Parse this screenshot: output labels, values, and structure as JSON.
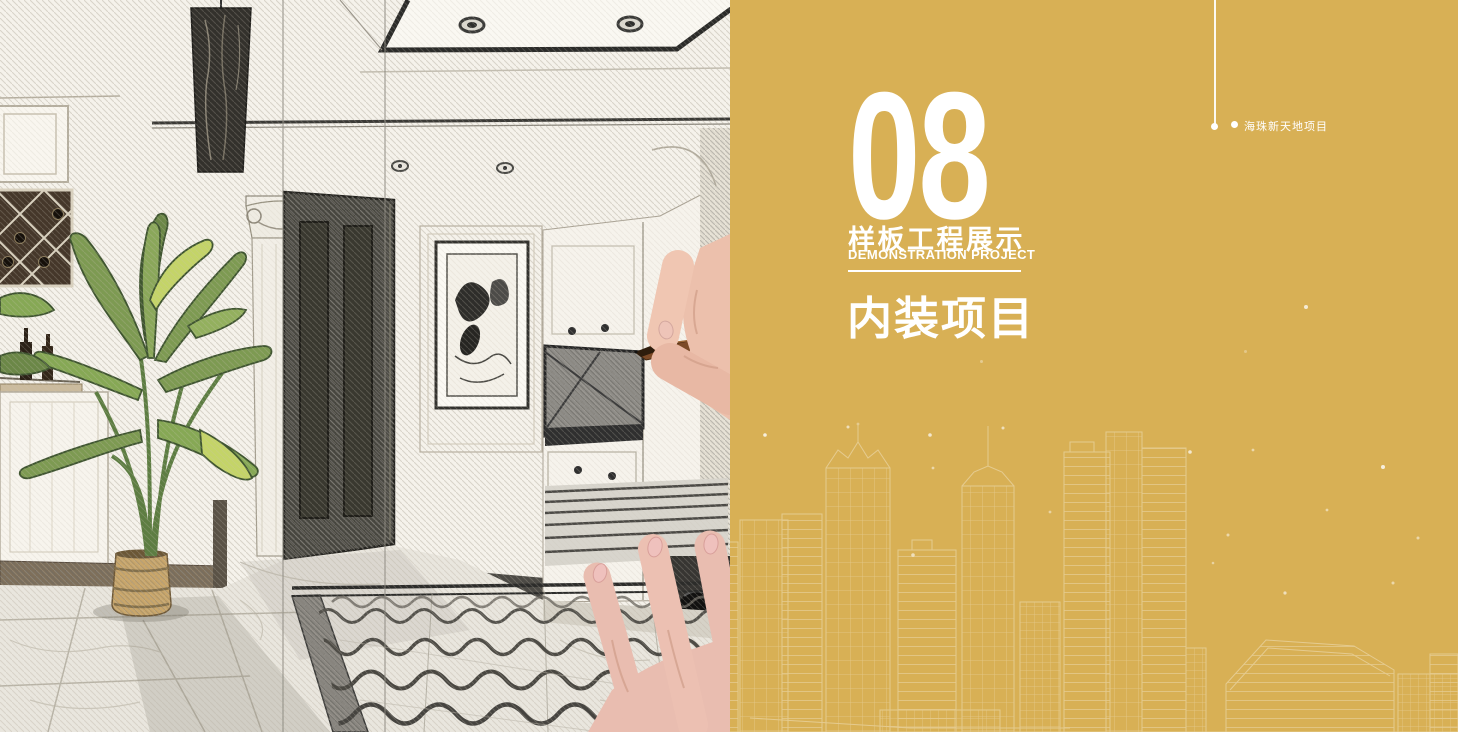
{
  "theme": {
    "gold": "#d8b055",
    "text_white": "#ffffff",
    "sketch_paper": "#f4f1ea"
  },
  "right_panel": {
    "chapter_number": "08",
    "chapter_title_cn": "样板工程展示",
    "chapter_title_en": "DEMONSTRATION PROJECT",
    "section_title": "内装项目",
    "project_label": "海珠新天地项目"
  },
  "left_panel": {
    "illustration_alt": "Hand-drawn pencil sketch of a home entry interior with dark door, framed art, cabinets, wine rack, green potted plant, patterned marble floor and a hand drawing with a pencil"
  }
}
